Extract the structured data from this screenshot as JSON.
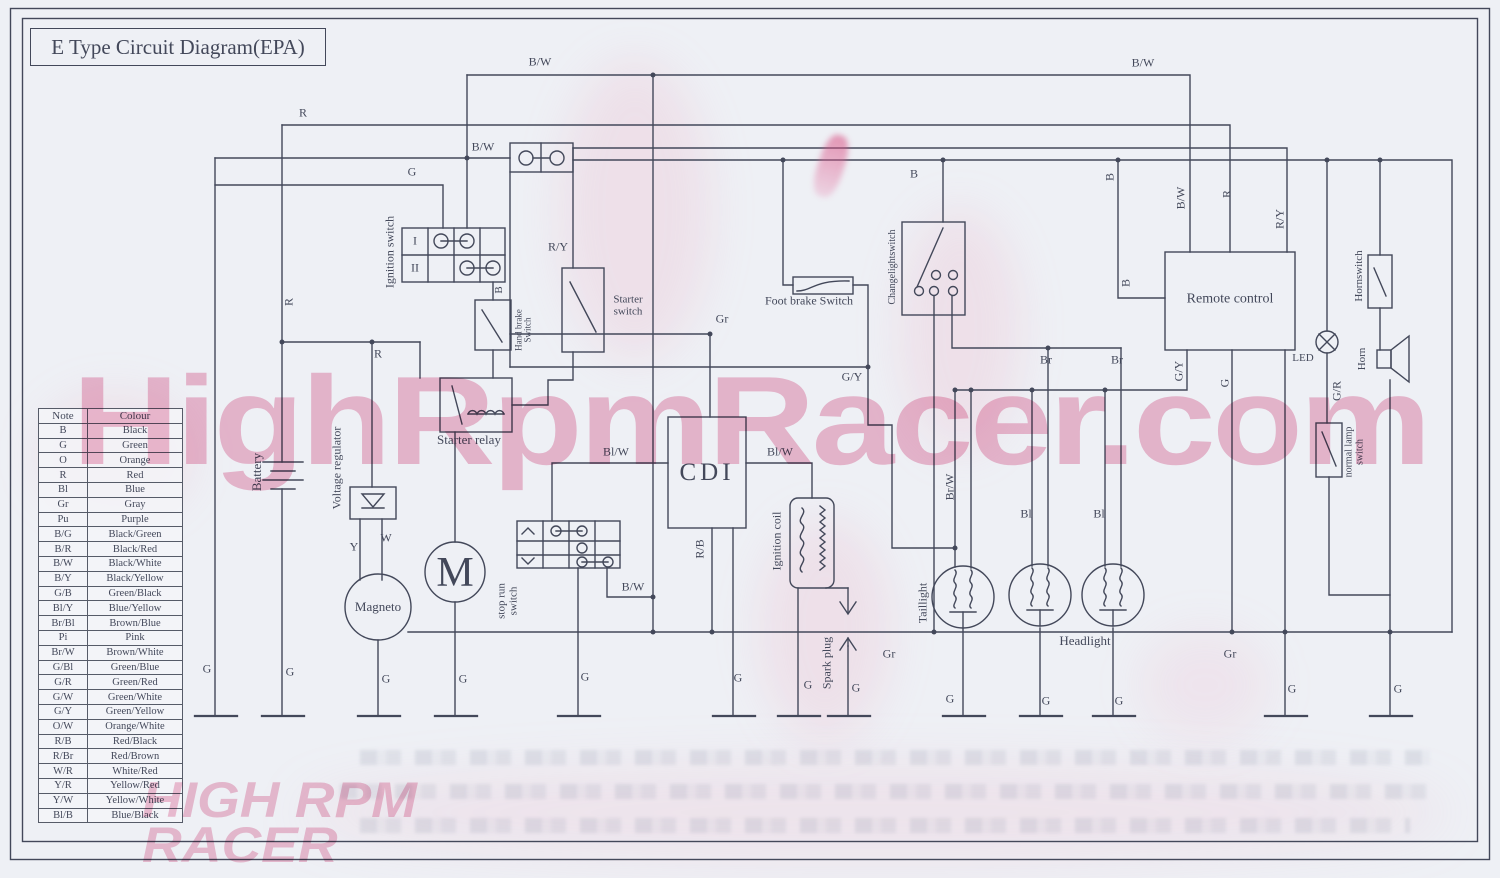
{
  "title": "E Type Circuit Diagram(EPA)",
  "watermarks": {
    "main": "HighRpmRacer.com",
    "corner": "HIGH RPM\nRACER"
  },
  "colors": {
    "ink": "#43485a",
    "paper": "#eef0f5",
    "watermark_pink": "#ec96b9",
    "marker_pink": "#d8497e"
  },
  "legend": {
    "headers": [
      "Note",
      "Colour"
    ],
    "rows": [
      [
        "B",
        "Black"
      ],
      [
        "G",
        "Green"
      ],
      [
        "O",
        "Orange"
      ],
      [
        "R",
        "Red"
      ],
      [
        "Bl",
        "Blue"
      ],
      [
        "Gr",
        "Gray"
      ],
      [
        "Pu",
        "Purple"
      ],
      [
        "B/G",
        "Black/Green"
      ],
      [
        "B/R",
        "Black/Red"
      ],
      [
        "B/W",
        "Black/White"
      ],
      [
        "B/Y",
        "Black/Yellow"
      ],
      [
        "G/B",
        "Green/Black"
      ],
      [
        "Bl/Y",
        "Blue/Yellow"
      ],
      [
        "Br/Bl",
        "Brown/Blue"
      ],
      [
        "Pi",
        "Pink"
      ],
      [
        "Br/W",
        "Brown/White"
      ],
      [
        "G/Bl",
        "Green/Blue"
      ],
      [
        "G/R",
        "Green/Red"
      ],
      [
        "G/W",
        "Green/White"
      ],
      [
        "G/Y",
        "Green/Yellow"
      ],
      [
        "O/W",
        "Orange/White"
      ],
      [
        "R/B",
        "Red/Black"
      ],
      [
        "R/Br",
        "Red/Brown"
      ],
      [
        "W/R",
        "White/Red"
      ],
      [
        "Y/R",
        "Yellow/Red"
      ],
      [
        "Y/W",
        "Yellow/White"
      ],
      [
        "Bl/B",
        "Blue/Black"
      ]
    ]
  },
  "labels": [
    {
      "name": "wire-label-bw-top-left",
      "text": "B/W",
      "x": 540,
      "y": 62
    },
    {
      "name": "wire-label-bw-top-right",
      "text": "B/W",
      "x": 1143,
      "y": 63
    },
    {
      "name": "wire-label-r-top",
      "text": "R",
      "x": 303,
      "y": 113
    },
    {
      "name": "wire-label-bw-connector",
      "text": "B/W",
      "x": 483,
      "y": 147
    },
    {
      "name": "wire-label-g-ignition",
      "text": "G",
      "x": 412,
      "y": 172
    },
    {
      "name": "wire-label-ry-starter",
      "text": "R/Y",
      "x": 558,
      "y": 247
    },
    {
      "name": "wire-label-gr-cdi",
      "text": "Gr",
      "x": 722,
      "y": 319
    },
    {
      "name": "wire-label-blw-cdi-left",
      "text": "Bl/W",
      "x": 616,
      "y": 452
    },
    {
      "name": "wire-label-blw-cdi-right",
      "text": "Bl/W",
      "x": 780,
      "y": 452
    },
    {
      "name": "wire-label-bw-stoprun",
      "text": "B/W",
      "x": 633,
      "y": 587
    },
    {
      "name": "wire-label-r-relay",
      "text": "R",
      "x": 378,
      "y": 354
    },
    {
      "name": "wire-label-y-magneto",
      "text": "Y",
      "x": 354,
      "y": 547
    },
    {
      "name": "wire-label-w-magneto",
      "text": "W",
      "x": 386,
      "y": 538
    },
    {
      "name": "wire-label-b-changeover",
      "text": "B",
      "x": 914,
      "y": 174
    },
    {
      "name": "wire-label-gy-footbrake",
      "text": "G/Y",
      "x": 852,
      "y": 377
    },
    {
      "name": "wire-label-br-headlight-1",
      "text": "Br",
      "x": 1046,
      "y": 360
    },
    {
      "name": "wire-label-br-headlight-2",
      "text": "Br",
      "x": 1117,
      "y": 360
    },
    {
      "name": "wire-label-bl-headlight-1",
      "text": "Bl",
      "x": 1026,
      "y": 514
    },
    {
      "name": "wire-label-bl-headlight-2",
      "text": "Bl",
      "x": 1099,
      "y": 514
    },
    {
      "name": "wire-label-gr-bus-left",
      "text": "Gr",
      "x": 889,
      "y": 654
    },
    {
      "name": "wire-label-gr-bus-right",
      "text": "Gr",
      "x": 1230,
      "y": 654
    },
    {
      "name": "led-label",
      "text": "LED",
      "x": 1303,
      "y": 359,
      "fs": 11
    },
    {
      "name": "ground-label-1",
      "text": "G",
      "x": 207,
      "y": 669
    },
    {
      "name": "ground-label-2",
      "text": "G",
      "x": 290,
      "y": 672
    },
    {
      "name": "ground-label-3",
      "text": "G",
      "x": 386,
      "y": 679
    },
    {
      "name": "ground-label-4",
      "text": "G",
      "x": 463,
      "y": 679
    },
    {
      "name": "ground-label-5",
      "text": "G",
      "x": 585,
      "y": 677
    },
    {
      "name": "ground-label-6",
      "text": "G",
      "x": 738,
      "y": 678
    },
    {
      "name": "ground-label-7",
      "text": "G",
      "x": 808,
      "y": 685
    },
    {
      "name": "ground-label-8",
      "text": "G",
      "x": 856,
      "y": 688
    },
    {
      "name": "ground-label-9",
      "text": "G",
      "x": 950,
      "y": 699
    },
    {
      "name": "ground-label-10",
      "text": "G",
      "x": 1046,
      "y": 701
    },
    {
      "name": "ground-label-11",
      "text": "G",
      "x": 1119,
      "y": 701
    },
    {
      "name": "ground-label-12",
      "text": "G",
      "x": 1292,
      "y": 689
    },
    {
      "name": "ground-label-13",
      "text": "G",
      "x": 1398,
      "y": 689
    },
    {
      "name": "wire-label-b-handbrake",
      "text": "B",
      "x": 500,
      "y": 290,
      "rot": -90,
      "fs": 11
    },
    {
      "name": "wire-label-r-battery",
      "text": "R",
      "x": 289,
      "y": 302,
      "rot": -90
    },
    {
      "name": "wire-label-bw-remote",
      "text": "B/W",
      "x": 1181,
      "y": 198,
      "rot": -90
    },
    {
      "name": "wire-label-r-remote",
      "text": "R",
      "x": 1227,
      "y": 194,
      "rot": -90
    },
    {
      "name": "wire-label-ry-remote",
      "text": "R/Y",
      "x": 1280,
      "y": 219,
      "rot": -90
    },
    {
      "name": "wire-label-b-remote-left",
      "text": "B",
      "x": 1126,
      "y": 283,
      "rot": -90
    },
    {
      "name": "wire-label-b-junction",
      "text": "B",
      "x": 1110,
      "y": 177,
      "rot": -90
    },
    {
      "name": "wire-label-gy-remote",
      "text": "G/Y",
      "x": 1179,
      "y": 371,
      "rot": -90
    },
    {
      "name": "wire-label-g-remote",
      "text": "G",
      "x": 1225,
      "y": 383,
      "rot": -90
    },
    {
      "name": "wire-label-gr-lamp-switch",
      "text": "G/R",
      "x": 1337,
      "y": 391,
      "rot": -90
    },
    {
      "name": "wire-label-brw-taillight",
      "text": "Br/W",
      "x": 950,
      "y": 487,
      "rot": -90
    },
    {
      "name": "wire-label-rb-cdi",
      "text": "R/B",
      "x": 700,
      "y": 549,
      "rot": -90
    },
    {
      "name": "spark-plug-label",
      "text": "Spark plug",
      "x": 827,
      "y": 663,
      "rot": -90
    },
    {
      "name": "battery-label",
      "text": "Battery",
      "x": 257,
      "y": 472,
      "rot": -90,
      "fs": 13
    },
    {
      "name": "voltage-regulator-label",
      "text": "Voltage regulator",
      "x": 337,
      "y": 468,
      "rot": -90
    },
    {
      "name": "ignition-switch-label",
      "text": "Ignition switch",
      "x": 390,
      "y": 252,
      "rot": -90
    },
    {
      "name": "hand-brake-switch-label",
      "text": "Hand brake\nSwitch",
      "x": 524,
      "y": 330,
      "rot": -90,
      "fs": 9
    },
    {
      "name": "stop-run-switch-label",
      "text": "stop run\nswitch",
      "x": 508,
      "y": 601,
      "rot": -90,
      "fs": 11
    },
    {
      "name": "ignition-coil-label",
      "text": "Ignition coil",
      "x": 777,
      "y": 541,
      "rot": -90
    },
    {
      "name": "changeover-switch-label",
      "text": "Changelightswitch",
      "x": 893,
      "y": 267,
      "rot": -90,
      "fs": 10
    },
    {
      "name": "taillight-label",
      "text": "Taillight",
      "x": 923,
      "y": 603,
      "rot": -90
    },
    {
      "name": "hornswitch-label",
      "text": "Hornswitch",
      "x": 1360,
      "y": 276,
      "rot": -90,
      "fs": 11
    },
    {
      "name": "horn-label",
      "text": "Horn",
      "x": 1363,
      "y": 359,
      "rot": -90,
      "fs": 11
    },
    {
      "name": "normal-lamp-switch-label",
      "text": "normal lamp\nswitch",
      "x": 1355,
      "y": 452,
      "rot": -90,
      "fs": 10
    },
    {
      "name": "foot-brake-switch-label",
      "text": "Foot brake Switch",
      "x": 809,
      "y": 301
    },
    {
      "name": "starter-relay-label",
      "text": "Starter relay",
      "x": 469,
      "y": 440,
      "cls": "comp"
    },
    {
      "name": "starter-switch-label",
      "text": "Starter\nswitch",
      "x": 628,
      "y": 306,
      "fs": 11
    },
    {
      "name": "magneto-label",
      "text": "Magneto",
      "x": 378,
      "y": 607,
      "cls": "comp"
    },
    {
      "name": "starter-motor-label",
      "text": "M",
      "x": 455,
      "y": 573,
      "cls": "big-m"
    },
    {
      "name": "cdi-label",
      "text": "CDI",
      "x": 707,
      "y": 473,
      "cls": "cdi"
    },
    {
      "name": "remote-control-label",
      "text": "Remote control",
      "x": 1230,
      "y": 300,
      "fs": 14
    },
    {
      "name": "headlight-label",
      "text": "Headlight",
      "x": 1085,
      "y": 641,
      "cls": "comp"
    },
    {
      "name": "ignition-position-i",
      "text": "I",
      "x": 415,
      "y": 241
    },
    {
      "name": "ignition-position-ii",
      "text": "II",
      "x": 415,
      "y": 268
    }
  ]
}
